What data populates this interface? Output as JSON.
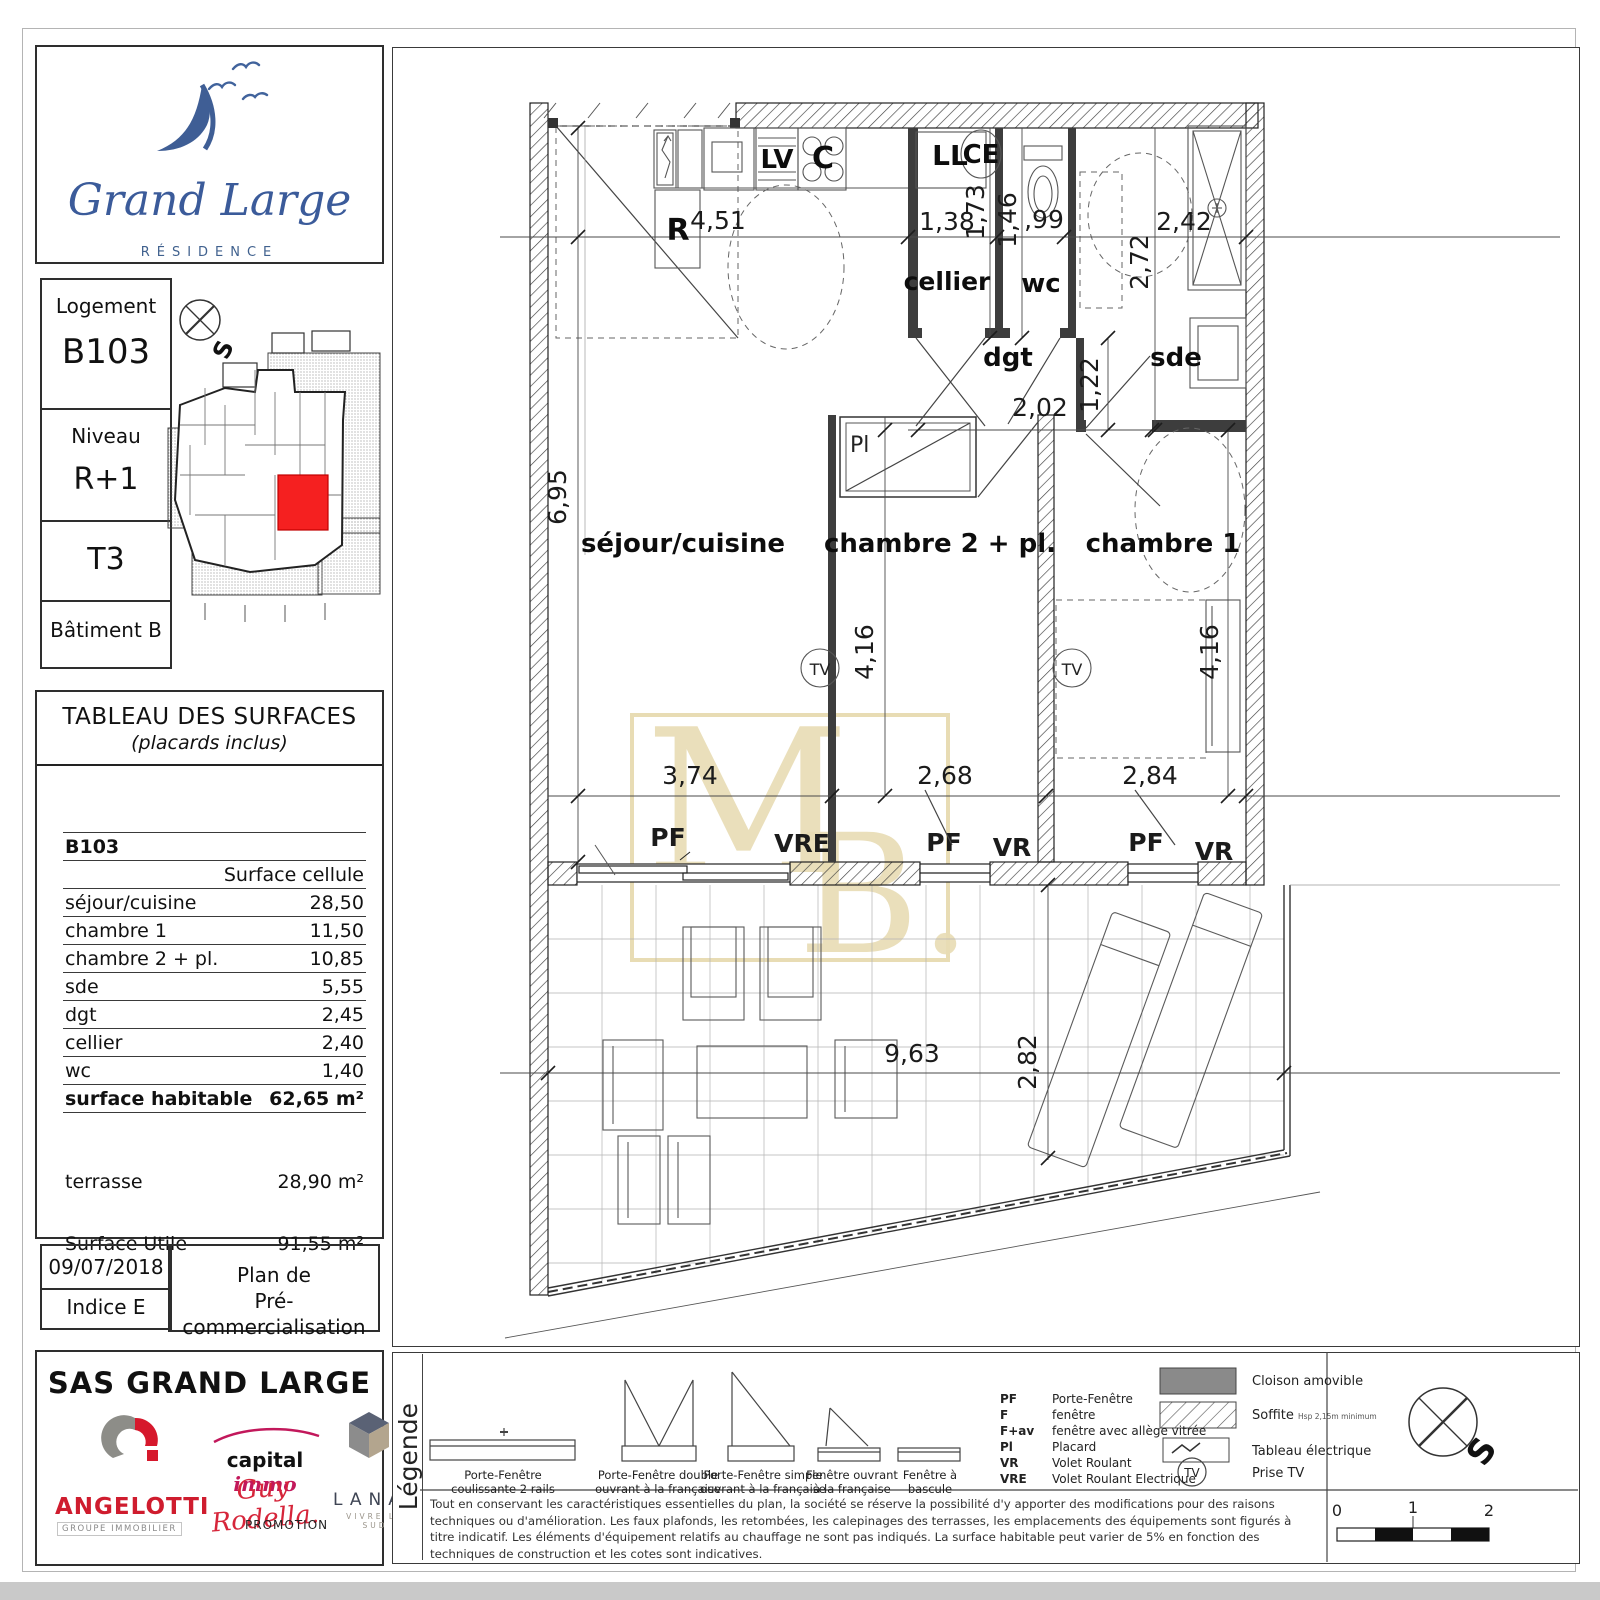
{
  "logo": {
    "name": "Grand Large",
    "subtitle": "RÉSIDENCE"
  },
  "info": {
    "logement_label": "Logement",
    "logement_value": "B103",
    "niveau_label": "Niveau",
    "niveau_value": "R+1",
    "type_value": "T3",
    "batiment_value": "Bâtiment B",
    "compass_s": "S"
  },
  "surfaces": {
    "title": "TABLEAU DES SURFACES",
    "subtitle": "(placards inclus)",
    "unit_id": "B103",
    "col_header": "Surface cellule",
    "rows": [
      {
        "label": "séjour/cuisine",
        "value": "28,50"
      },
      {
        "label": "chambre 1",
        "value": "11,50"
      },
      {
        "label": "chambre 2 + pl.",
        "value": "10,85"
      },
      {
        "label": "sde",
        "value": "5,55"
      },
      {
        "label": "dgt",
        "value": "2,45"
      },
      {
        "label": "cellier",
        "value": "2,40"
      },
      {
        "label": "wc",
        "value": "1,40"
      }
    ],
    "total_label": "surface habitable",
    "total_value": "62,65 m²",
    "extras": [
      {
        "label": "terrasse",
        "value": "28,90 m²"
      },
      {
        "label": "Surface Utile",
        "value": "91,55 m²"
      }
    ]
  },
  "revision": {
    "date": "09/07/2018",
    "indice": "Indice  E",
    "plan_line1": "Plan de",
    "plan_line2": "Pré-commercialisation"
  },
  "company": {
    "title": "SAS GRAND LARGE",
    "angelotti": "ANGELOTTI",
    "angelotti_sub": "GROUPE IMMOBILIER",
    "capital": "capital",
    "immo": "immo",
    "signature": "Guy Rodella.",
    "promotion": "PROMOTION",
    "lanat": "LANAT",
    "lanat_sub": "VIVRE LE SUD"
  },
  "sheet": {
    "watermark_m": "M",
    "watermark_b": "B."
  },
  "plan": {
    "rooms": {
      "sejour": "séjour/cuisine",
      "chambre2": "chambre 2 + pl.",
      "chambre1": "chambre 1",
      "cellier": "cellier",
      "wc": "wc",
      "dgt": "dgt",
      "sde": "sde"
    },
    "labels": {
      "r": "R",
      "lv": "LV",
      "c": "C",
      "ll": "LL",
      "ce": "CE",
      "tv": "TV",
      "pl": "Pl",
      "pf": "PF",
      "vr": "VR",
      "vre": "VRE"
    },
    "dims": {
      "sejour_top": "4,51",
      "cellier_top": "1,38",
      "cellier_side": "1,73",
      "wc_side": "1,46",
      "wc_top": ",99",
      "sde_top": "2,42",
      "sde_side": "2,72",
      "sejour_side": "6,95",
      "dgt_top": "2,02",
      "dgt_side": "1,22",
      "ch2_side": "4,16",
      "ch1_side": "4,16",
      "sejour_bottom": "3,74",
      "ch2_bottom": "2,68",
      "ch1_bottom": "2,84",
      "terrace_bottom": "9,63",
      "terrace_side": "2,82"
    }
  },
  "legend": {
    "title": "Légende",
    "windows": [
      {
        "l1": "Porte-Fenêtre",
        "l2": "coulissante 2 rails"
      },
      {
        "l1": "Porte-Fenêtre double",
        "l2": "ouvrant à la française"
      },
      {
        "l1": "Porte-Fenêtre simple",
        "l2": "ouvrant à la française"
      },
      {
        "l1": "Fenêtre ouvrant",
        "l2": "à la française"
      },
      {
        "l1": "Fenêtre à",
        "l2": "bascule"
      }
    ],
    "abbr": [
      {
        "k": "PF",
        "v": "Porte-Fenêtre"
      },
      {
        "k": "F",
        "v": "fenêtre"
      },
      {
        "k": "F+av",
        "v": "fenêtre avec allège vitrée"
      },
      {
        "k": "Pl",
        "v": "Placard"
      },
      {
        "k": "VR",
        "v": "Volet Roulant"
      },
      {
        "k": "VRE",
        "v": "Volet Roulant Electrique"
      }
    ],
    "symbols": [
      {
        "label": "Cloison amovible"
      },
      {
        "label": "Soffite",
        "note": "Hsp 2,15m minimum"
      },
      {
        "label": "Tableau électrique"
      },
      {
        "label": "Prise TV"
      }
    ],
    "tv": "TV",
    "compass_s": "S",
    "scale": [
      "0",
      "1",
      "2"
    ],
    "disclaimer": "Tout en conservant les caractéristiques essentielles du plan, la société se réserve la possibilité d'y apporter des modifications pour des raisons techniques ou d'amélioration. Les faux plafonds, les retombées, les calepinages des terrasses, les emplacements des équipements sont figurés à titre indicatif. Les éléments d'équipement relatifs au chauffage ne sont pas indiqués. La surface habitable peut varier de 5% en fonction des techniques de construction et les cotes sont indicatives."
  }
}
